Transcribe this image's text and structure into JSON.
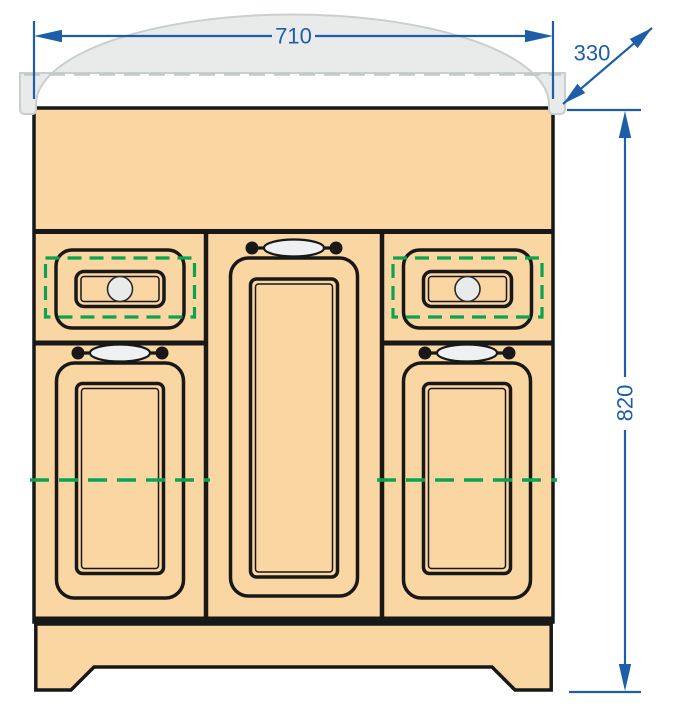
{
  "drawing": {
    "subject": "vanity-cabinet-front-elevation",
    "dimensions": {
      "width_label": "710",
      "depth_label": "330",
      "height_label": "820"
    },
    "colors": {
      "dimension_blue": "#1C5FA8",
      "cabinet_wood": "#FAD6A2",
      "outline_black": "#181818",
      "highlight_green": "#0AA34E",
      "sink_gray": "#E9EAEA"
    }
  }
}
